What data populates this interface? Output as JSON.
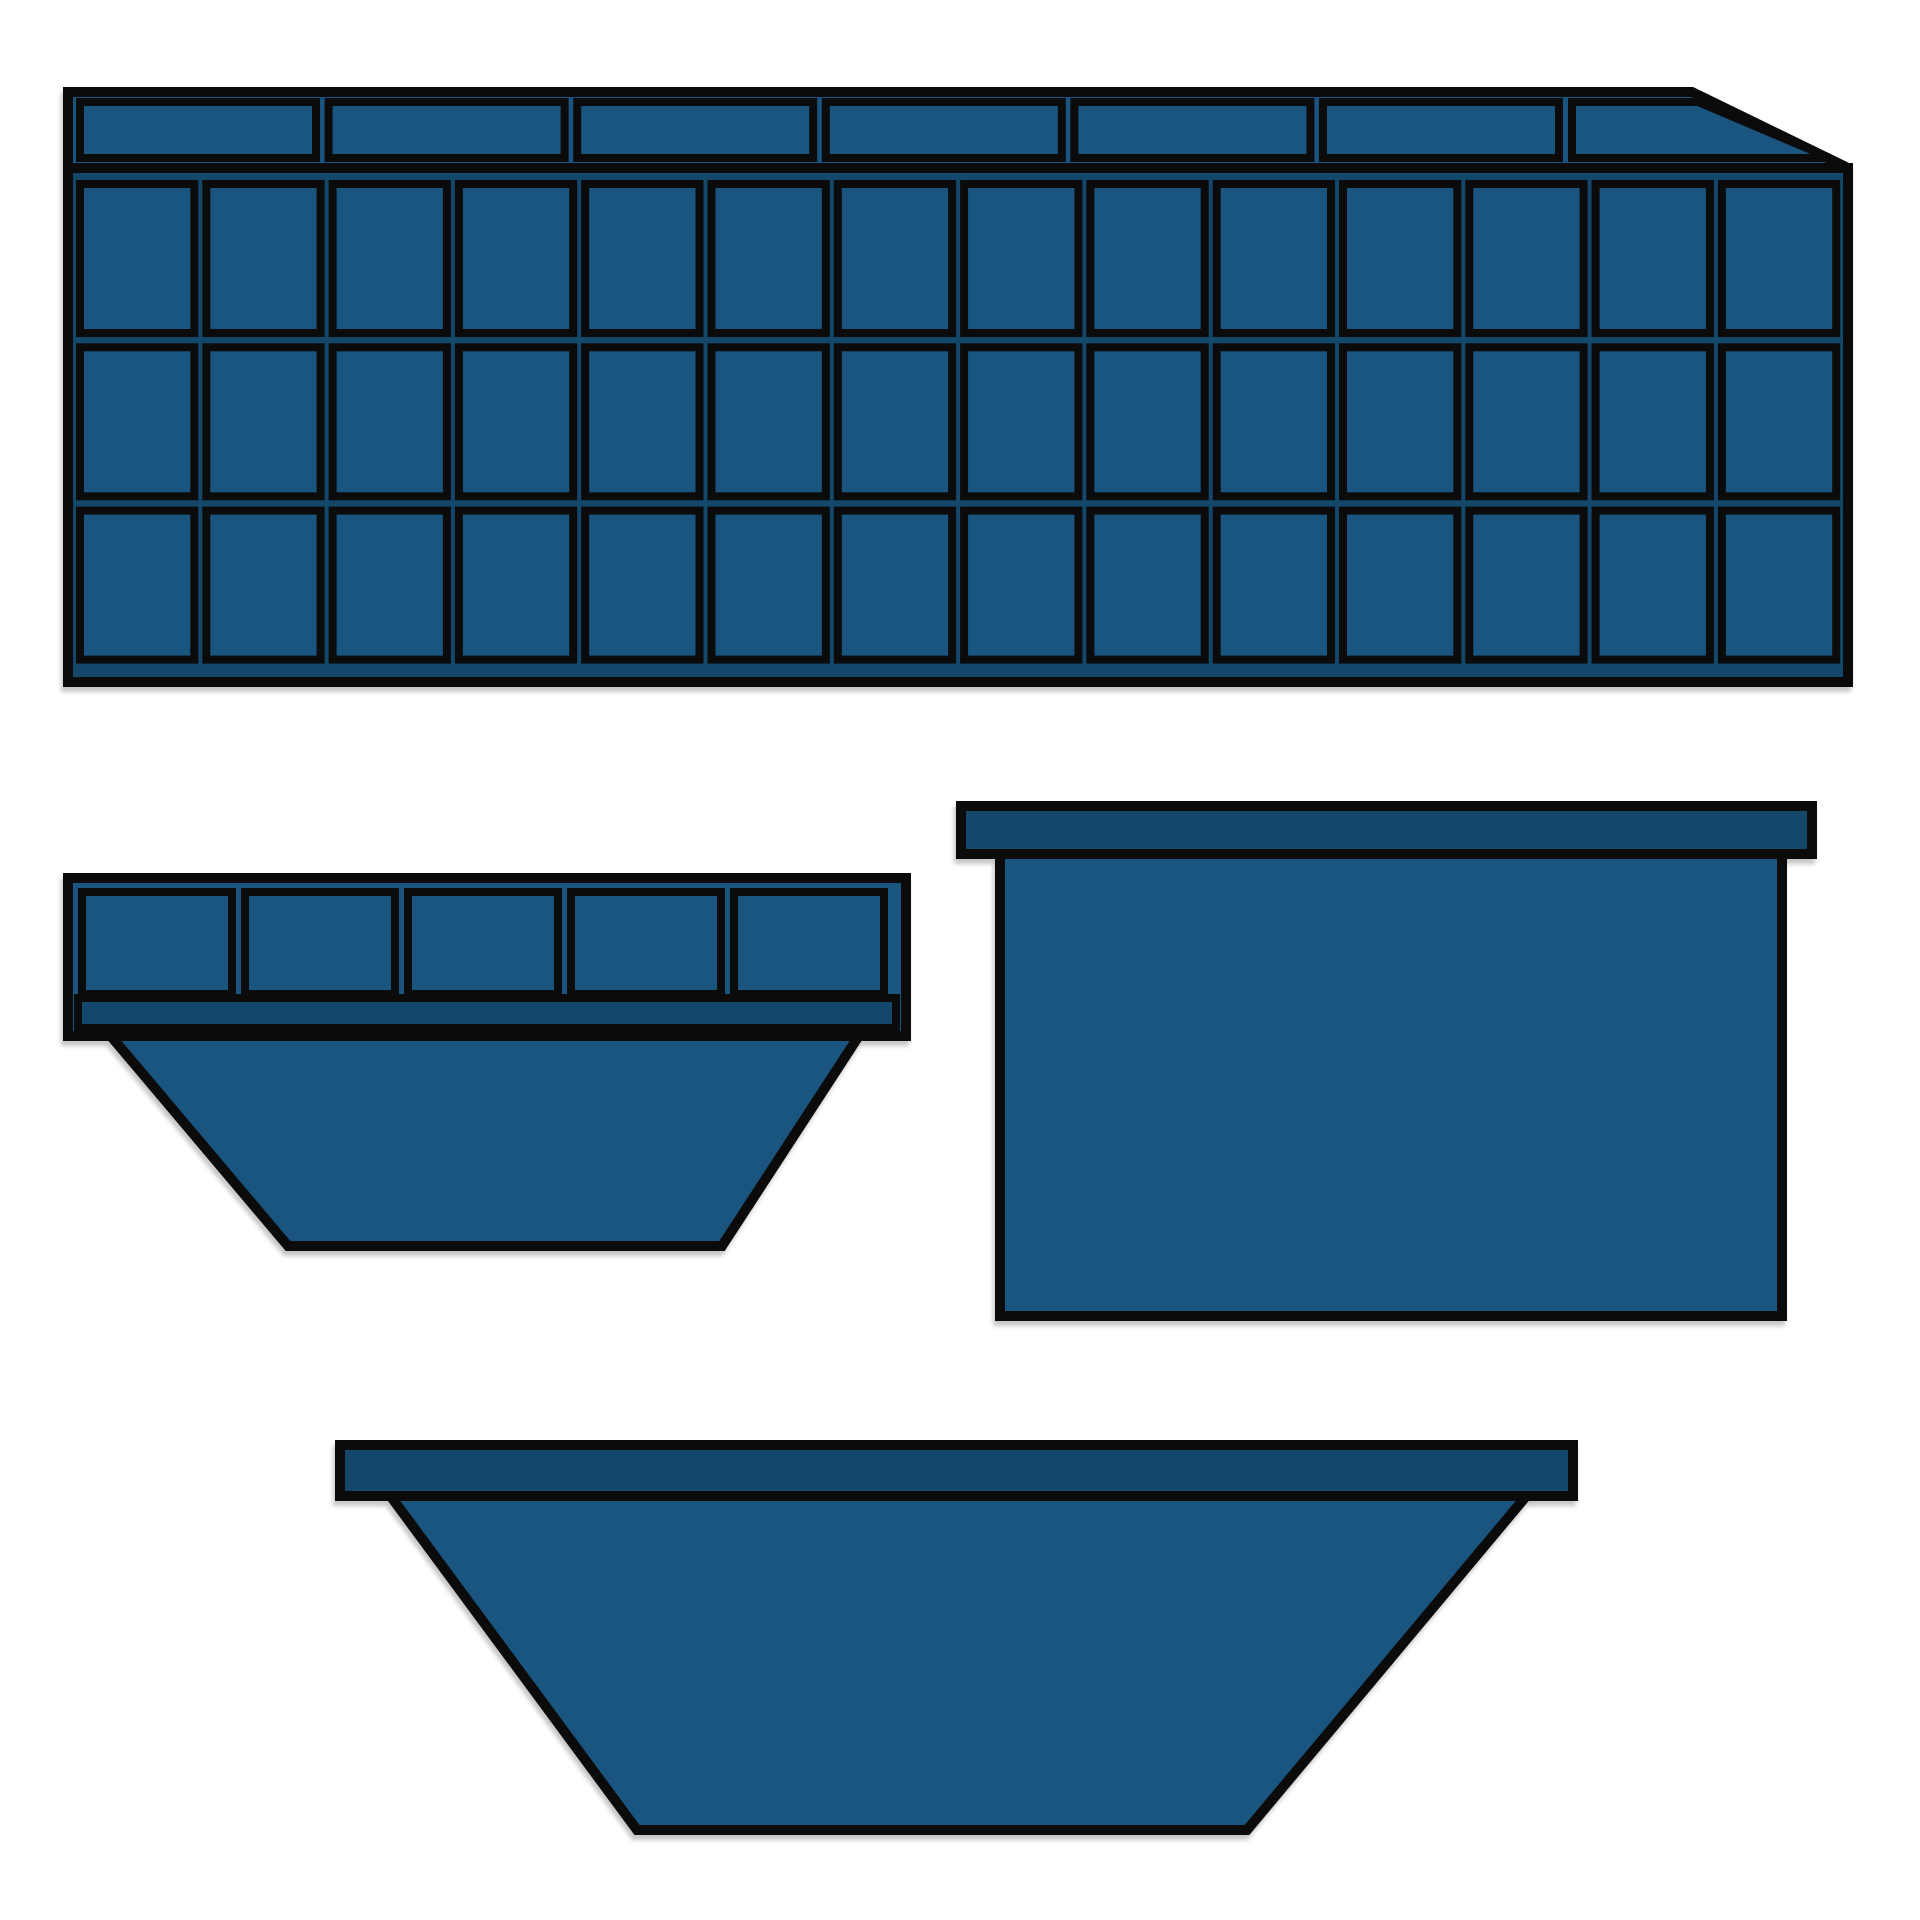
{
  "canvas": {
    "width": 1920,
    "height": 1920,
    "viewbox": "0 0 1920 1920",
    "background": "#ffffff"
  },
  "palette": {
    "main": "#1A5580",
    "dark": "#14486B",
    "outline": "#0B0B0B"
  },
  "shapes": [
    {
      "id": "panelled-container-illustration",
      "elements": [
        {
          "kind": "rect",
          "name": "container-body",
          "x": 68,
          "y": 168,
          "w": 1780,
          "h": 514,
          "fill": "dark",
          "stroke": 10
        },
        {
          "kind": "grid",
          "name": "container-panel",
          "x": 80,
          "y": 184,
          "cols": 14,
          "rows": 3,
          "cell_w": 114.3,
          "cell_h": 149,
          "col_gap": 12,
          "row_gap": 14.3,
          "fill": "main",
          "stroke": 8
        },
        {
          "kind": "polygon",
          "name": "container-top-rail",
          "points": "68,92 1692,92 1848,168 68,168",
          "fill": "main",
          "stroke": 10
        },
        {
          "kind": "grid",
          "name": "rail-segment",
          "x": 80,
          "y": 102,
          "cols": 6,
          "rows": 1,
          "cell_w": 236,
          "cell_h": 56,
          "col_gap": 12.6,
          "row_gap": 0,
          "fill": "main",
          "stroke": 8
        },
        {
          "kind": "polygon",
          "name": "rail-segment-chamfered",
          "points": "1572,102 1698,102 1830,158 1572,158",
          "fill": "main",
          "stroke": 8
        }
      ]
    },
    {
      "id": "small-skip-illustration",
      "elements": [
        {
          "kind": "polygon",
          "name": "skip-tub",
          "points": "104,1028 864,1028 722,1246 288,1246",
          "fill": "main",
          "stroke": 10
        },
        {
          "kind": "rect",
          "name": "skip-top-frame",
          "x": 68,
          "y": 878,
          "w": 838,
          "h": 158,
          "fill": "main",
          "stroke": 10
        },
        {
          "kind": "grid",
          "name": "skip-frame-panel",
          "x": 82,
          "y": 892,
          "cols": 5,
          "rows": 1,
          "cell_w": 150,
          "cell_h": 102,
          "col_gap": 13,
          "row_gap": 0,
          "fill": "main",
          "stroke": 8
        },
        {
          "kind": "rect",
          "name": "skip-frame-band",
          "x": 78,
          "y": 998,
          "w": 818,
          "h": 30,
          "fill": "dark",
          "stroke": 8
        }
      ]
    },
    {
      "id": "box-container-illustration",
      "elements": [
        {
          "kind": "rect",
          "name": "box-body",
          "x": 1000,
          "y": 852,
          "w": 782,
          "h": 464,
          "fill": "main",
          "stroke": 10
        },
        {
          "kind": "rect",
          "name": "box-lip",
          "x": 961,
          "y": 806,
          "w": 851,
          "h": 48,
          "fill": "dark",
          "stroke": 10
        }
      ]
    },
    {
      "id": "large-skip-illustration",
      "elements": [
        {
          "kind": "polygon",
          "name": "skip-tub",
          "points": "389,1494 1528,1494 1247,1830 637,1830",
          "fill": "main",
          "stroke": 10
        },
        {
          "kind": "rect",
          "name": "skip-lip",
          "x": 340,
          "y": 1445,
          "w": 1233,
          "h": 51,
          "fill": "dark",
          "stroke": 10
        }
      ]
    }
  ]
}
